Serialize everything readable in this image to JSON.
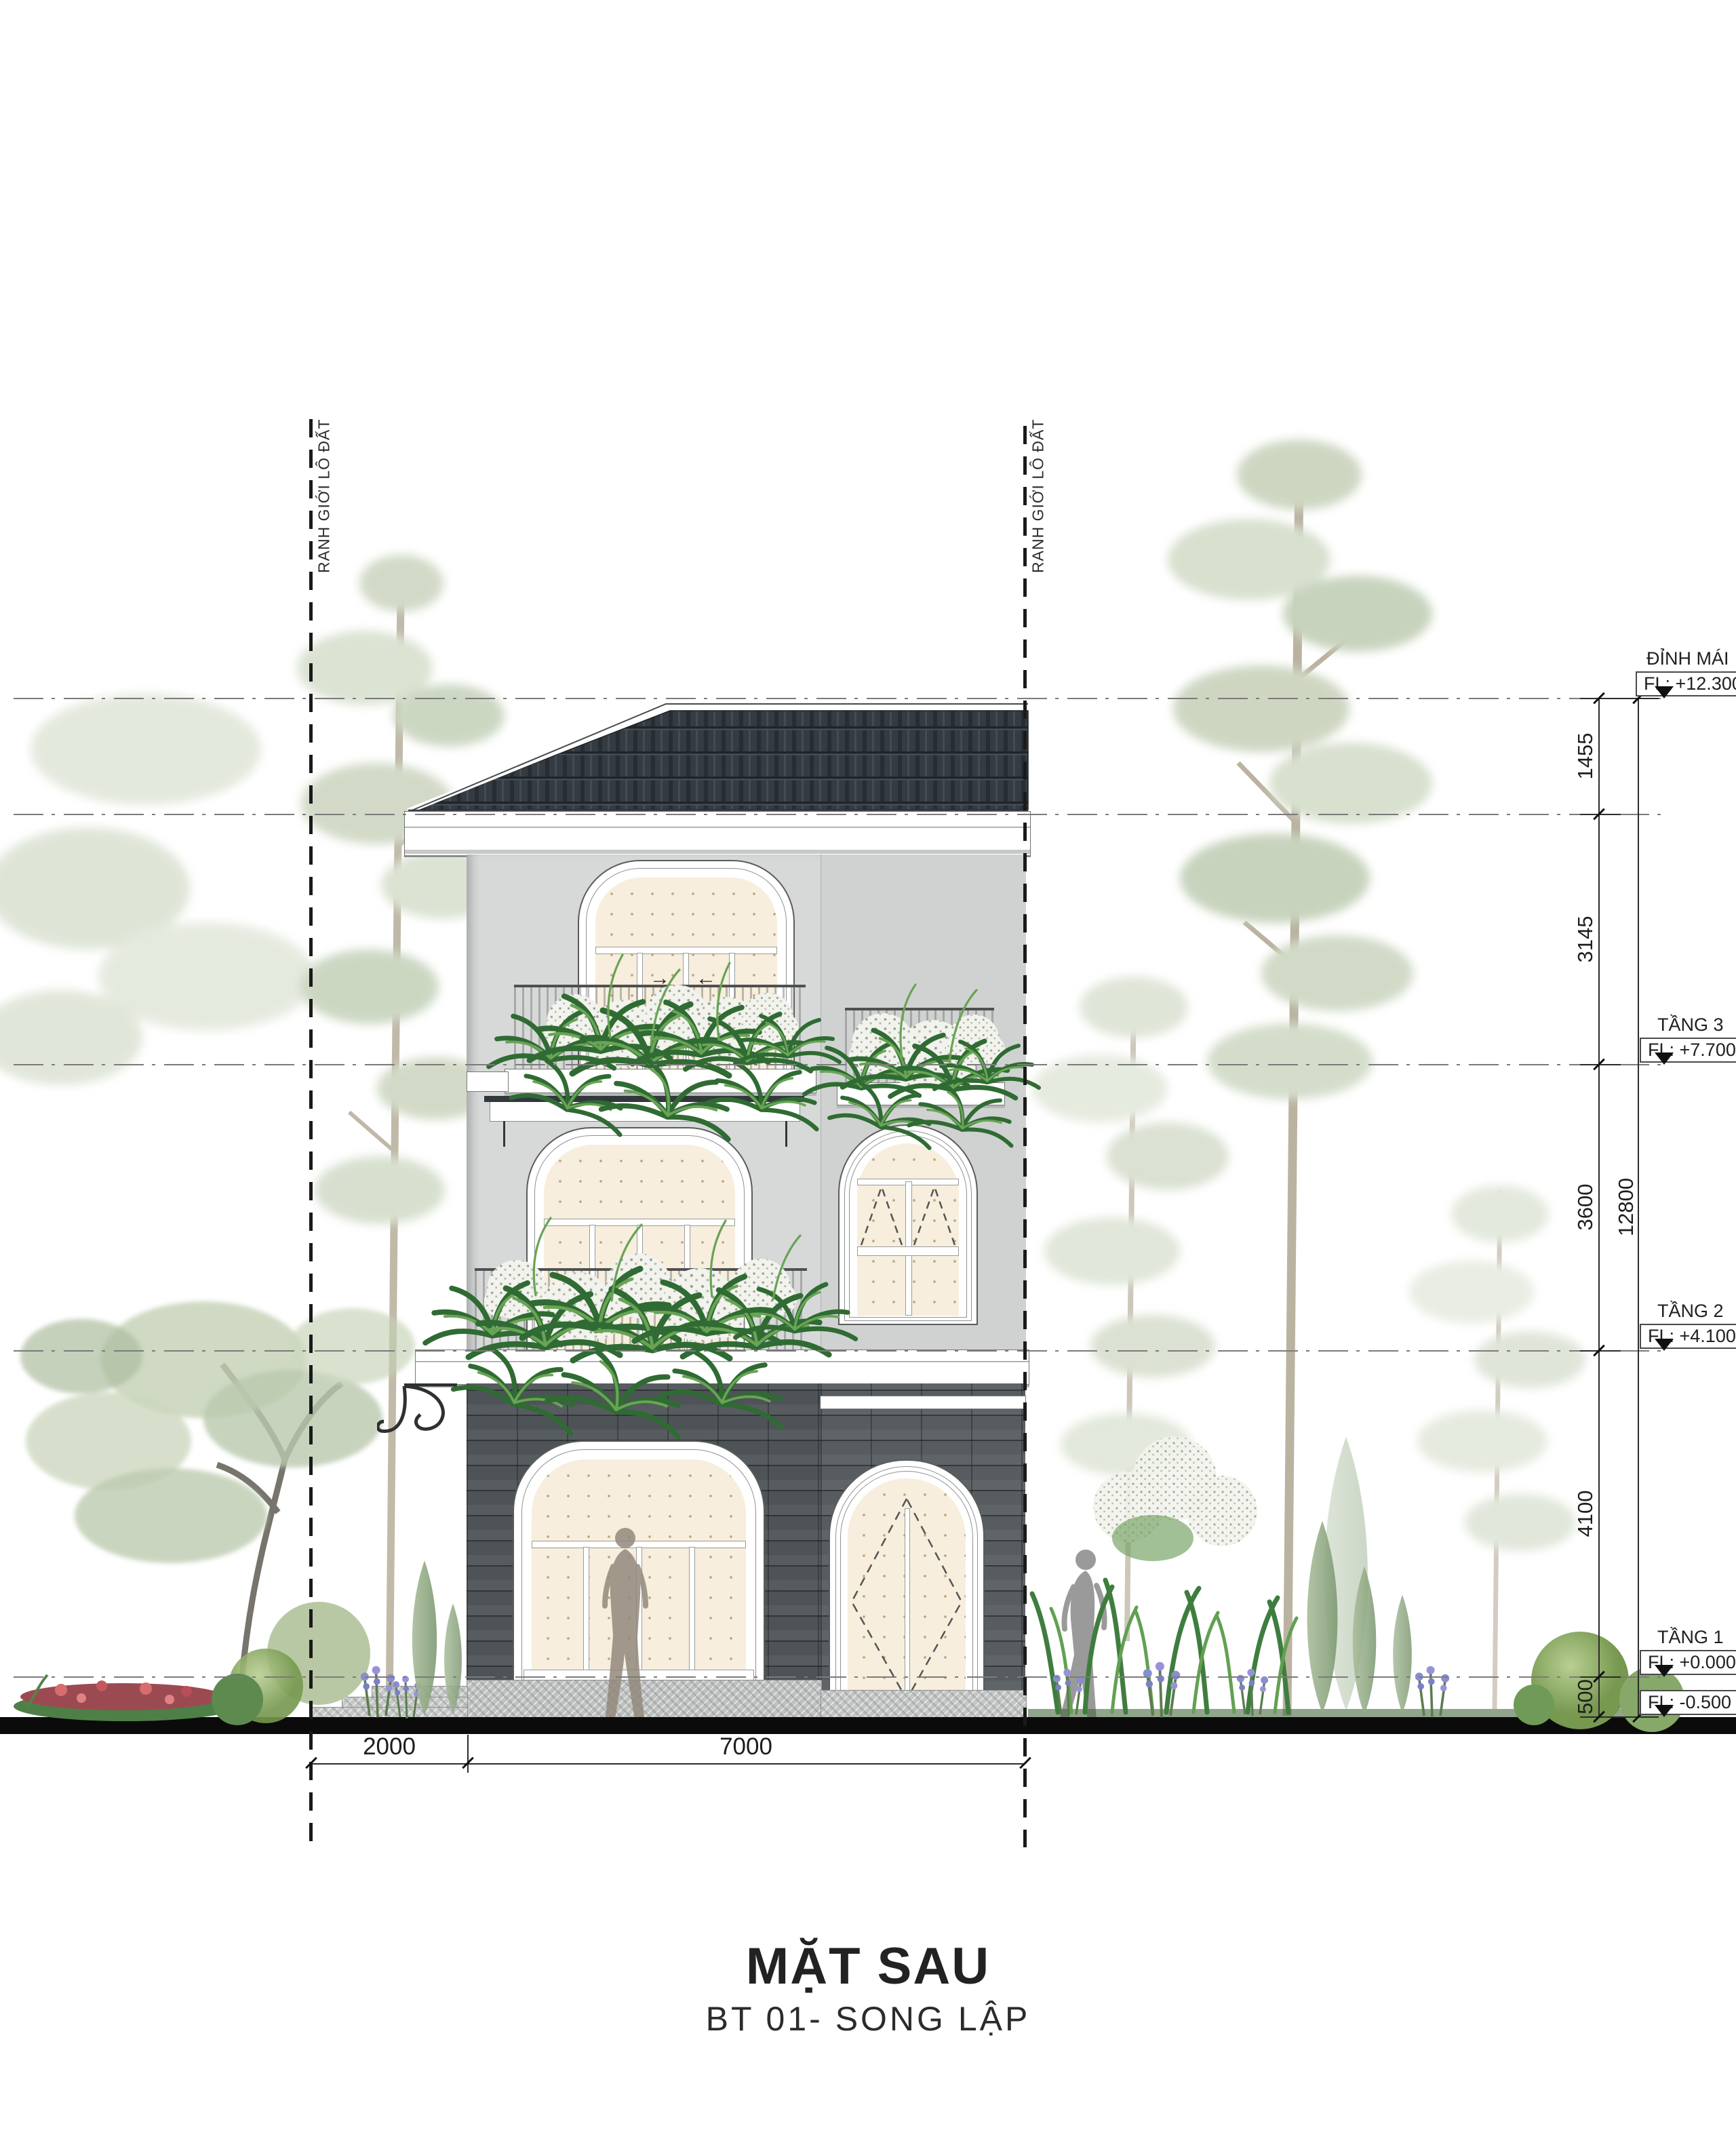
{
  "drawing": {
    "title": "MẶT SAU",
    "subtitle": "BT 01- SONG LẬP",
    "boundary_label_left": "RANH GIỚI LÔ ĐẤT",
    "boundary_label_right": "RANH GIỚI LÔ ĐẤT",
    "levels": [
      {
        "name": "ĐỈNH MÁI",
        "fl": "FL: +12.300"
      },
      {
        "name": "TẦNG 3",
        "fl": "FL: +7.700"
      },
      {
        "name": "TẦNG 2",
        "fl": "FL: +4.100"
      },
      {
        "name": "TẦNG 1",
        "fl": "FL: +0.000"
      },
      {
        "name": "",
        "fl": "FL: -0.500"
      }
    ],
    "dims_vertical": {
      "segments": [
        "1455",
        "3145",
        "3600",
        "4100",
        "500"
      ],
      "total": "12800"
    },
    "dims_horizontal": {
      "setback": "2000",
      "house_width": "7000"
    },
    "slide_arrows": {
      "right": "→",
      "left": "←"
    },
    "colors": {
      "roof_tile": "#343b42",
      "wall_upper": "#d7d9d8",
      "wall_lower": "#4d5356",
      "glazing": "#f7eedd",
      "trim": "#ffffff",
      "ground_bar": "#0b0b0b",
      "foliage": "#4e8a47",
      "faded_tree": "#b9c6ab"
    }
  }
}
